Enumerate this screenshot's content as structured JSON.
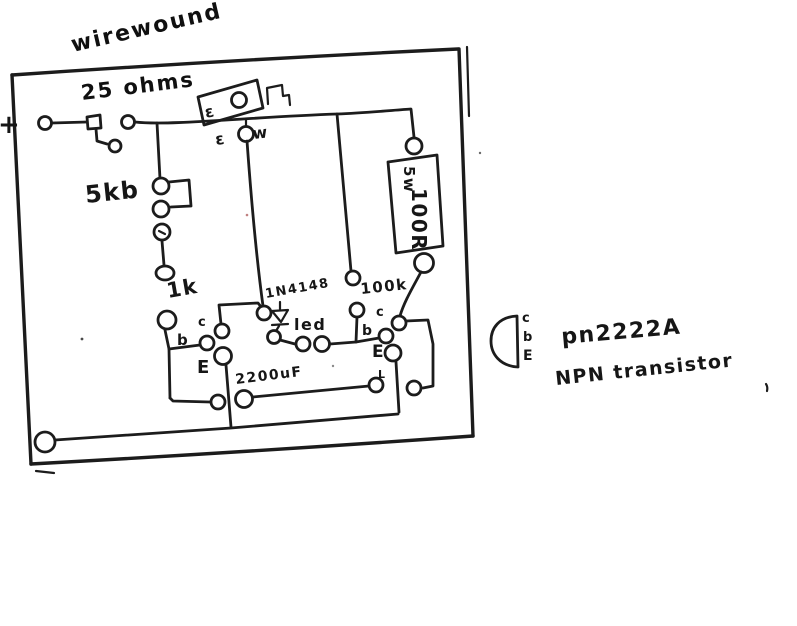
{
  "sketch": {
    "plus": "+",
    "pot": {
      "type_label": "wirewound",
      "value_label": "25 ohms",
      "mark_top": "ε",
      "mark_mid": "ε",
      "mark_wiper": "w"
    },
    "trimmer_label": "5kb",
    "resistor_1k_label": "1k",
    "diode_label": "1N4148",
    "led_label": "led",
    "resistor_100k_label": "100k",
    "capacitor_label": "2200uF",
    "power_resistor": {
      "wattage": "5w",
      "value": "100R"
    },
    "q1_pins": {
      "c": "c",
      "b": "b",
      "e": "E"
    },
    "q2_pins": {
      "c": "c",
      "b": "b",
      "e": "E",
      "stray_mark": "L"
    },
    "note": {
      "package_pins": {
        "c": "c",
        "b": "b",
        "e": "E"
      },
      "part_number": "pn2222A",
      "device_type": "NPN transistor"
    }
  }
}
